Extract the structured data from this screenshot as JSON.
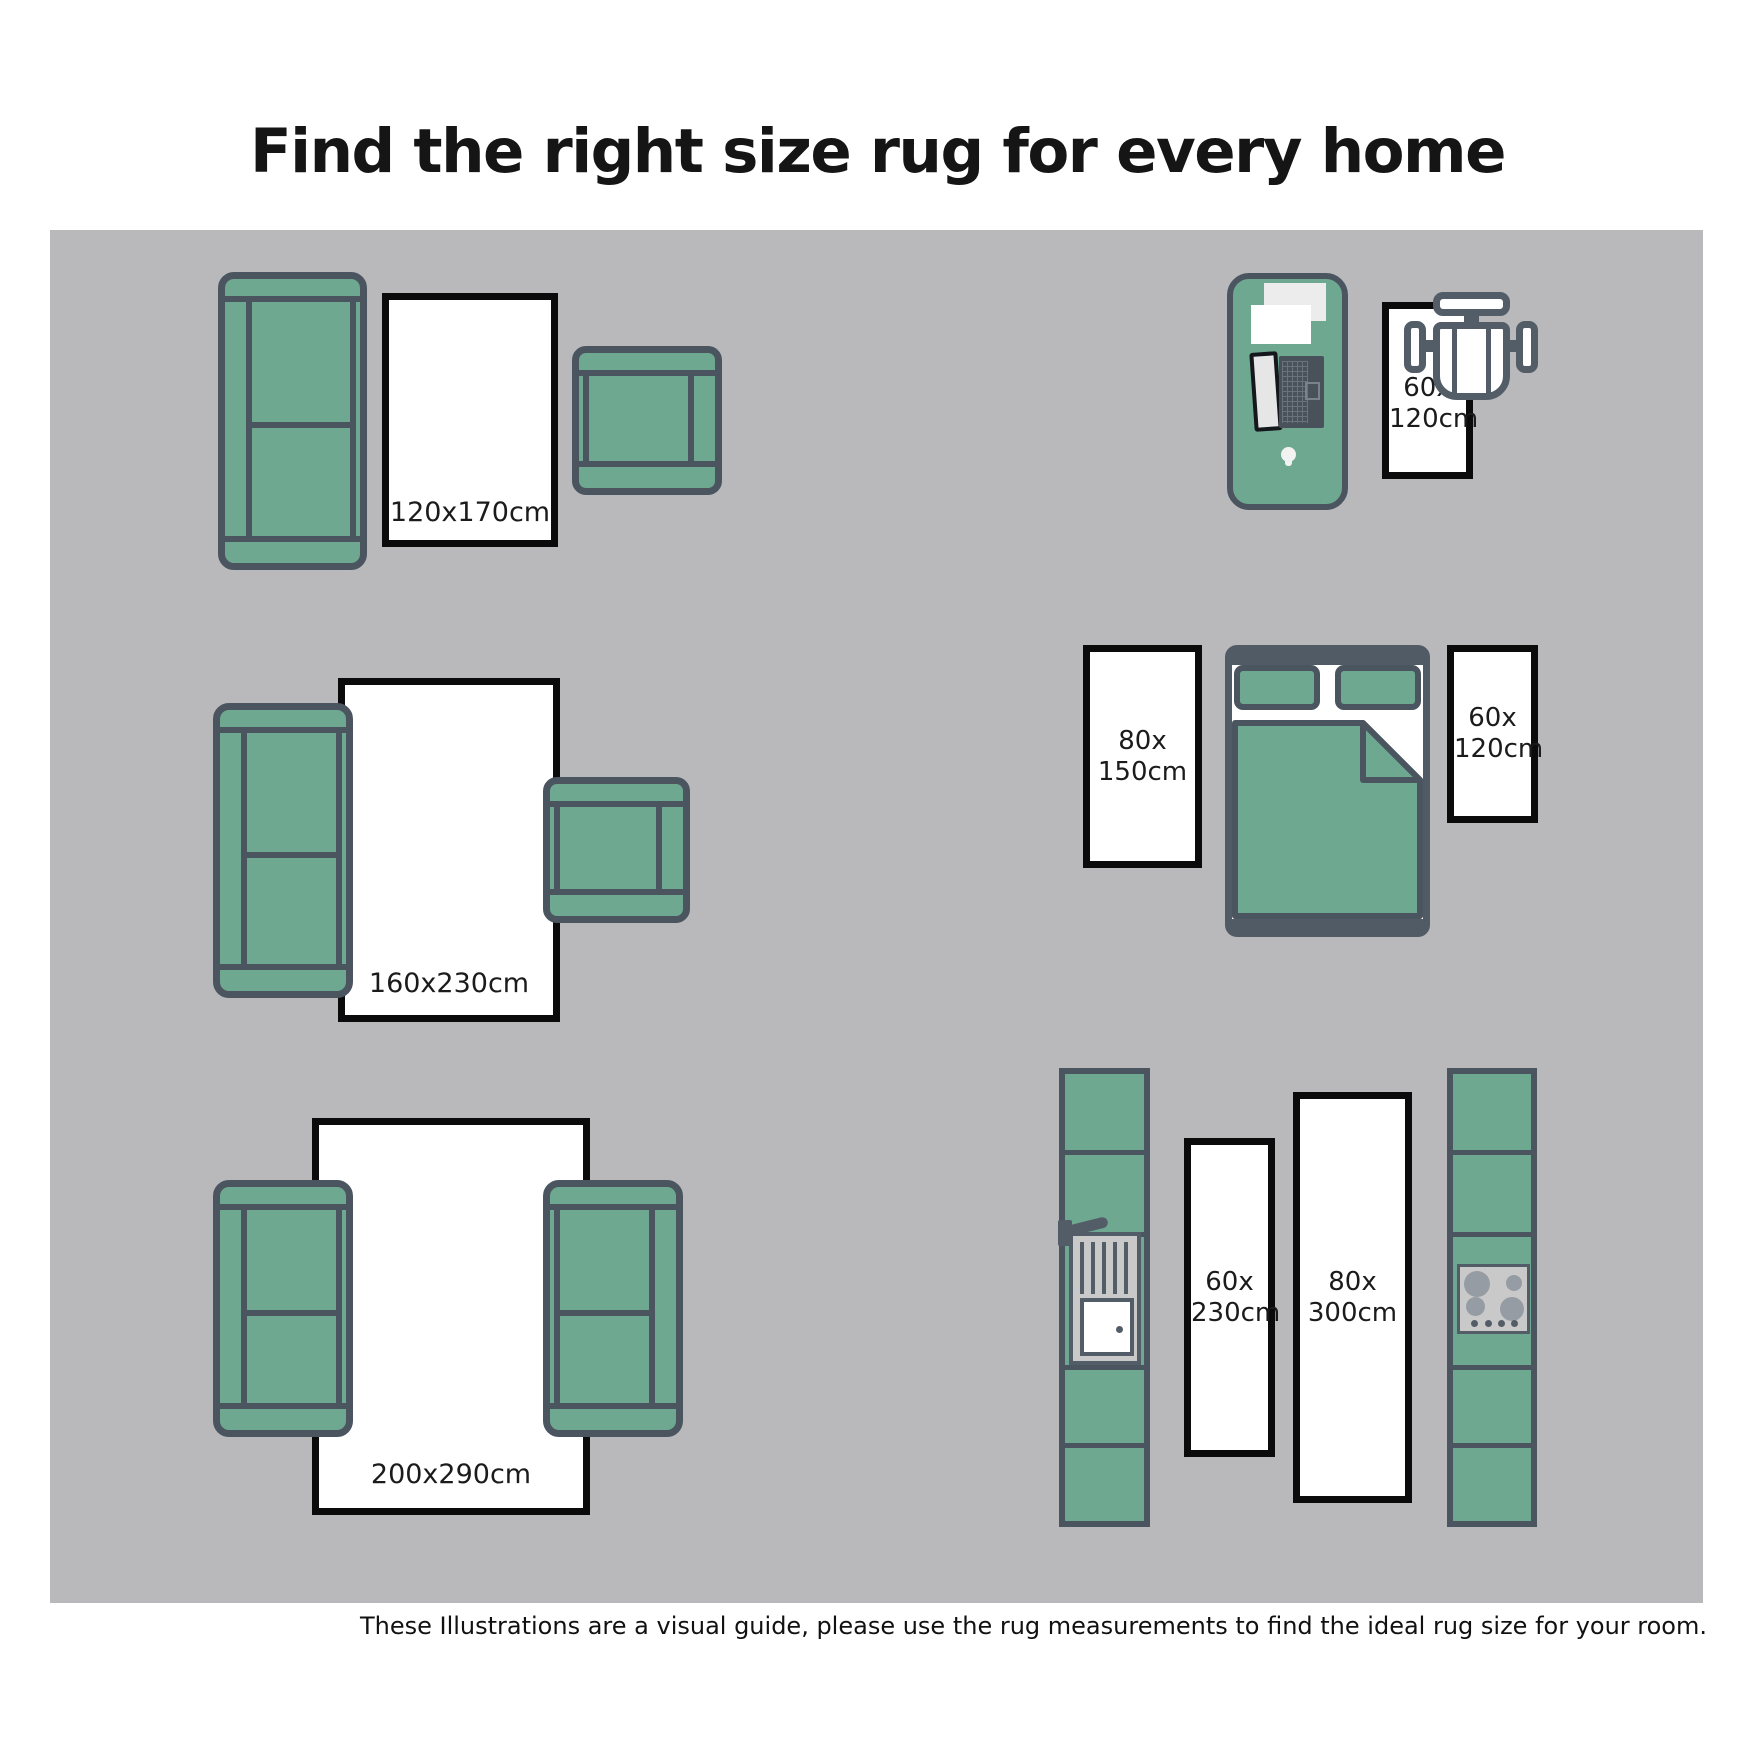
{
  "title": "Find the right size rug for every home",
  "footnote": "These Illustrations are a visual guide, please use the rug measurements to find the ideal rug size for your room.",
  "colors": {
    "furniture_green": "#6FA890",
    "furniture_outline": "#4B5560",
    "floor_gray": "#B9B9BB",
    "rug_border": "#0B0B0B",
    "text": "#1B1B1B"
  },
  "rugs": {
    "living_small": {
      "label": "120x170cm"
    },
    "office": {
      "line1": "60x",
      "line2": "120cm"
    },
    "living_medium": {
      "label": "160x230cm"
    },
    "bedroom_left": {
      "line1": "80x",
      "line2": "150cm"
    },
    "bedroom_right": {
      "line1": "60x",
      "line2": "120cm"
    },
    "living_large": {
      "label": "200x290cm"
    },
    "kitchen_left": {
      "line1": "60x",
      "line2": "230cm"
    },
    "kitchen_right": {
      "line1": "80x",
      "line2": "300cm"
    }
  },
  "icons": {
    "sofa": "css-shape",
    "armchair": "css-shape",
    "desk": "css-shape",
    "laptop": "css-shape",
    "papers": "css-shape",
    "computer-mouse": "css-shape",
    "office-chair": "css-shape",
    "bed": "css-shape",
    "pillow": "css-shape",
    "duvet": "svg-shape",
    "kitchen-counter": "css-shape",
    "sink": "css-shape",
    "cooktop": "css-shape"
  }
}
